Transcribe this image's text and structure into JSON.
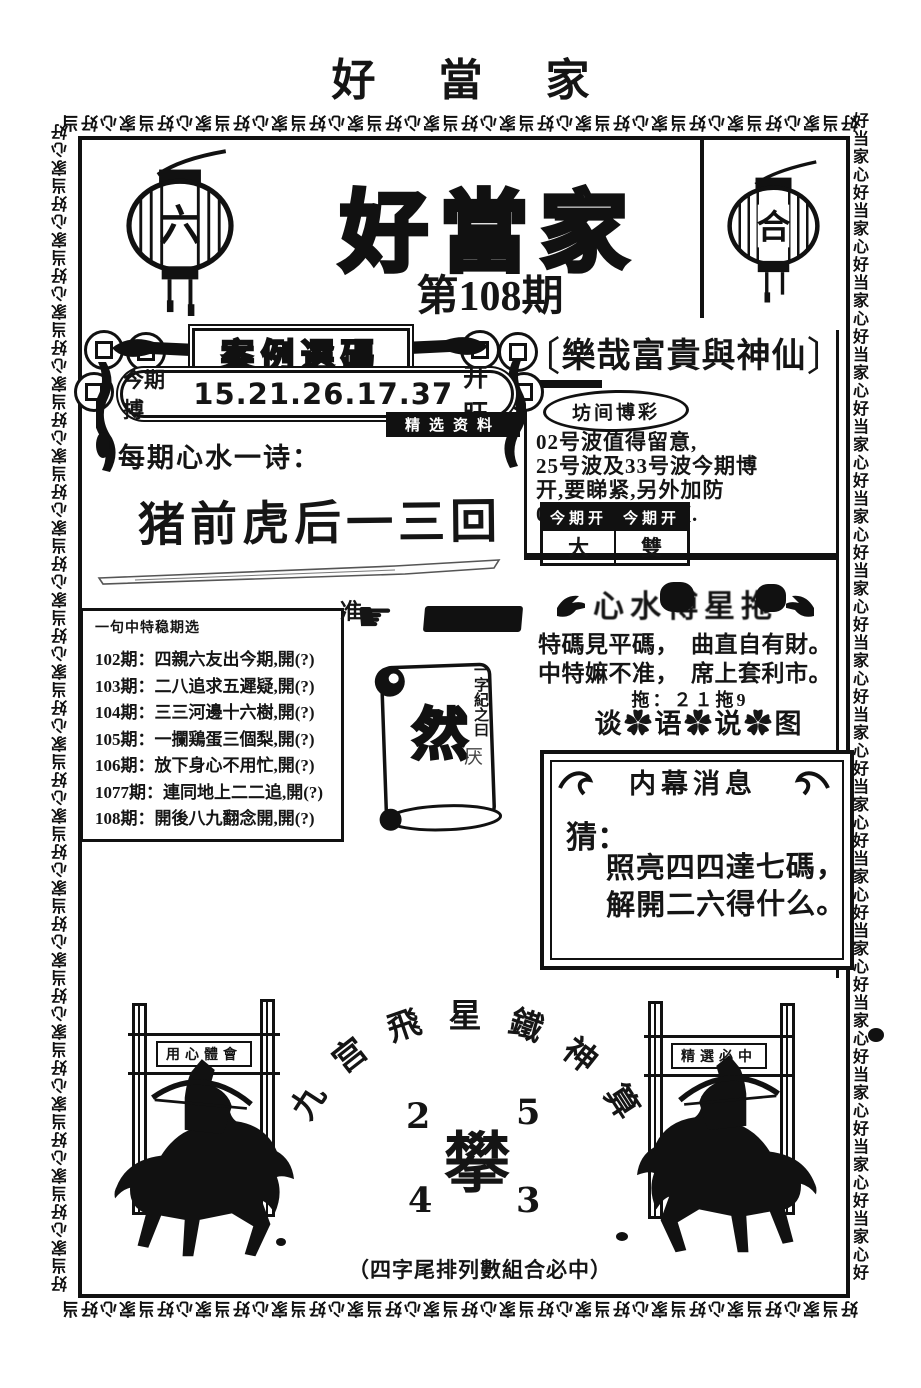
{
  "page": {
    "top_title": "好 當 家",
    "border_unit": "好当家心",
    "ink_color": "#111111",
    "paper_color": "#ffffff"
  },
  "icons": {
    "pointing_hand": "☛"
  },
  "header": {
    "main_title": "好當家",
    "issue_label": "第108期",
    "left_lantern_char": "六",
    "right_lantern_char": "合"
  },
  "left_column": {
    "banner_title": "案例選碼",
    "draw_label": "今期搏",
    "draw_numbers": "15.21.26.17.37",
    "draw_flag": "开旺",
    "black_tag": "精选资料",
    "poem_label": "每期心水一诗：",
    "poem_text": "猪前虎后一三回",
    "history_box": {
      "title": "一句中特稳期选",
      "rows": [
        "102期：四親六友出今期,開(?)",
        "103期：二八追求五遲疑,開(?)",
        "104期：三三河邊十六樹,開(?)",
        "105期：一攔鶏蛋三個梨,開(?)",
        "106期：放下身心不用忙,開(?)",
        "1077期：連同地上二二追,開(?)",
        "108期：開後八九翻念開,開(?)"
      ]
    },
    "hand_prefix_char": "准",
    "scroll": {
      "big_char": "然",
      "caption_vertical": "一字紀之曰",
      "side_char": "厌"
    }
  },
  "right_column": {
    "header_bracket_left": "〔",
    "header_title": "樂哉富貴與神仙",
    "header_bracket_right": "〕",
    "oval_title": "坊间博彩",
    "advice_lines": [
      "02号波值得留意,",
      "25号波及33号波今期博",
      "开,要睇紧,另外加防",
      "07号波及24号波."
    ],
    "result_table": {
      "headers": [
        "今期开",
        "今期开"
      ],
      "values": [
        "大",
        "雙"
      ]
    },
    "ribbon_banner_text": "心水博星拖",
    "verse_lines": [
      "特碼見平碼，　曲直自有財。",
      "中特嫲不准，　席上套利市。"
    ],
    "tuo_line": "拖：２１拖9",
    "flower_line": "谈✿语✿说✿图",
    "inside_news": {
      "title": "内幕消息",
      "guess_label": "猜：",
      "lines": [
        "照亮四四達七碼，",
        "解開二六得什么。"
      ]
    }
  },
  "bottom": {
    "arc_title": "九宫飛星鐵神算",
    "grid_numbers": {
      "top_left": "2",
      "top_right": "5",
      "bottom_left": "4",
      "bottom_right": "3"
    },
    "center_char": "攀",
    "caption": "（四字尾排列數組合必中）",
    "left_gate_banner": "用心體會",
    "right_gate_banner": "精選必中"
  }
}
